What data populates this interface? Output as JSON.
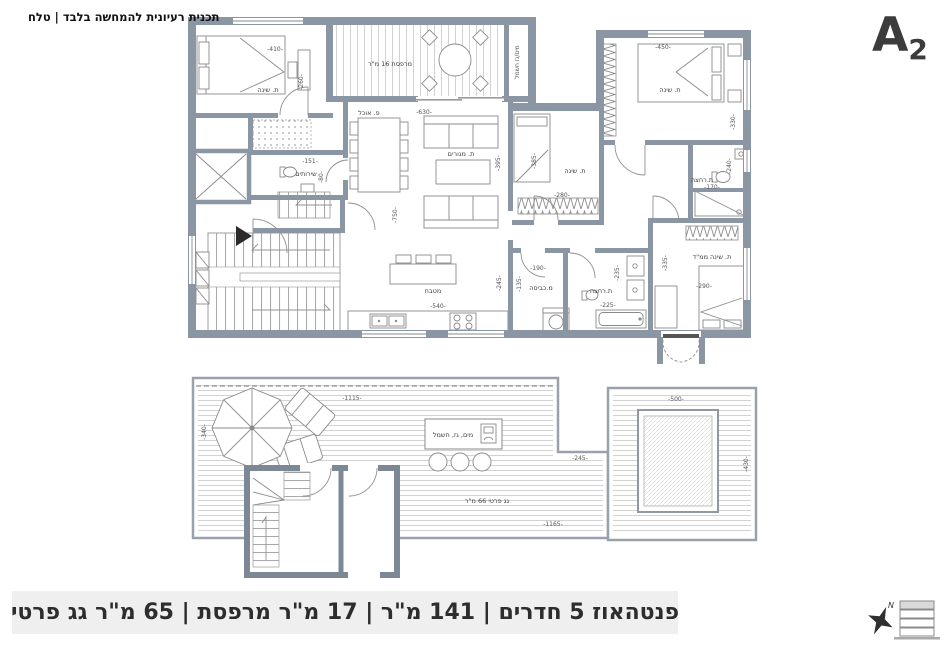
{
  "header": {
    "disclaimer": "תכנית רעיונית להמחשה בלבד | טלח",
    "plan_code": "A",
    "plan_code_sub": "2"
  },
  "floor_plan": {
    "rooms": {
      "bedroom1": {
        "label": "ת. שינה",
        "dim_w": "-410-",
        "dim_h": "-260-"
      },
      "balcony": {
        "label": "מרפסת 16 מ\"ר"
      },
      "shaft": {
        "label": "מים/גז חשמל"
      },
      "bedroom2": {
        "label": "ת. שינה",
        "dim_w": "-450-",
        "dim_h": "-330-"
      },
      "bath1": {
        "label": "ת.רחצה",
        "dim_w": "-170-",
        "dim_h": "-240-"
      },
      "bedroom3": {
        "label": "ת. שינה",
        "dim_w": "-280-",
        "dim_left": "-395-",
        "dim_right": "-385-"
      },
      "dining": {
        "label": "פ. אוכל"
      },
      "living": {
        "label": "ת. מגורים",
        "dim_w": "-630-",
        "dim_h": "-750-"
      },
      "kitchen": {
        "label": "מטבח",
        "dim_w": "-540-",
        "dim_h": "-245-"
      },
      "laundry": {
        "label": "מ.כביסה",
        "dim_w": "-190-",
        "dim_h": "-135-"
      },
      "bath2": {
        "label": "ת.רחצה",
        "dim_w": "-225-",
        "dim_h": "-235-"
      },
      "master": {
        "label": "ת. שינה ממ\"ד",
        "dim_w": "-290-",
        "dim_h": "-335-"
      },
      "wc": {
        "label": "שירותים",
        "dim_w": "-151-",
        "dim_h": "-80-"
      }
    }
  },
  "roof_plan": {
    "area_label": "גג פרטי 66 מ\"ר",
    "utility_label": "מים, גז, חשמל",
    "dim_top": "-1115-",
    "dim_left": "-340-",
    "dim_mid": "-245-",
    "dim_bottom": "-1165-",
    "skylight_dim_w": "-500-",
    "skylight_dim_h": "-430-"
  },
  "footer": {
    "summary": "פנטהאוז 5 חדרים | 141 מ\"ר | 17 מ\"ר מרפסת | 65 מ\"ר גג פרטי",
    "north_label": "N"
  },
  "colors": {
    "wall": "#8b96a5",
    "roof_wall": "#7d8896",
    "banner_bg": "#efefef",
    "text_dark": "#2d2d2d"
  }
}
